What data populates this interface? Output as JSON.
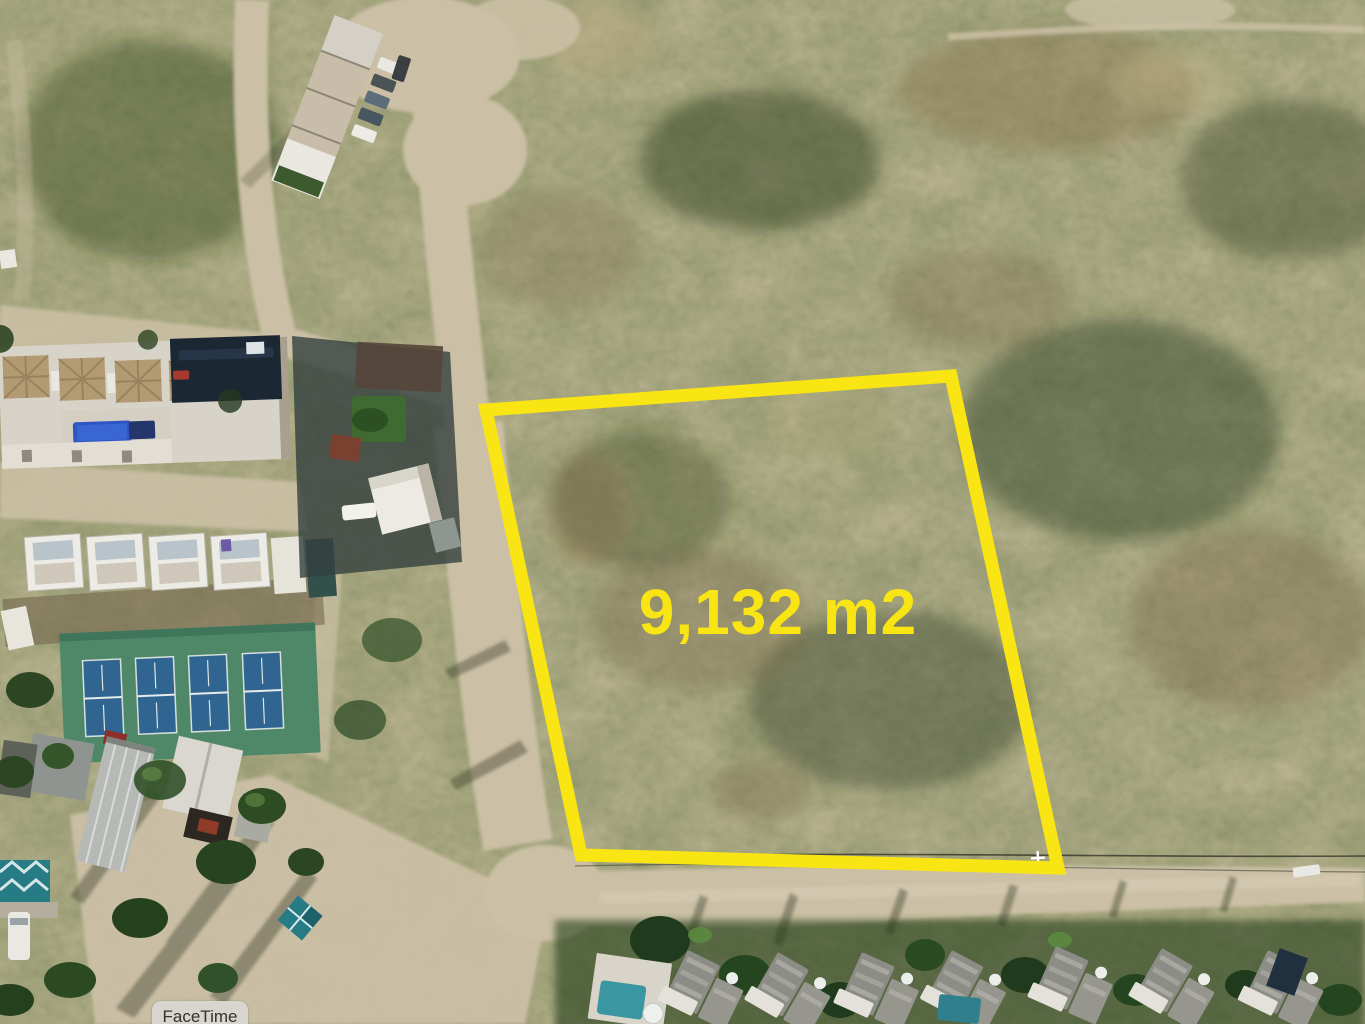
{
  "image": {
    "kind": "aerial-drone-photograph"
  },
  "overlay": {
    "parcel": {
      "area_label": "9,132 m2",
      "outline_points": "486,410 951,376 1058,868 581,855",
      "outline_width": 13
    },
    "facetime_button": {
      "label": "FaceTime"
    }
  },
  "palette": {
    "parcel_yellow": "#f9e514",
    "facetime_bg": "#d8d4ce",
    "facetime_text": "#33322f",
    "sand": "#cbc0a5",
    "sand_light": "#dcd2ba",
    "scrub_base": "#57613f",
    "scrub_dark": "#2d3d23",
    "scrub_brown": "#7a6847",
    "pool_blue": "#2f55c4",
    "court_green": "#4e8868",
    "court_blue": "#2f6590",
    "teal_structure": "#277b84",
    "roof_gray": "#8d8d88",
    "building_white": "#e9e7e0"
  }
}
